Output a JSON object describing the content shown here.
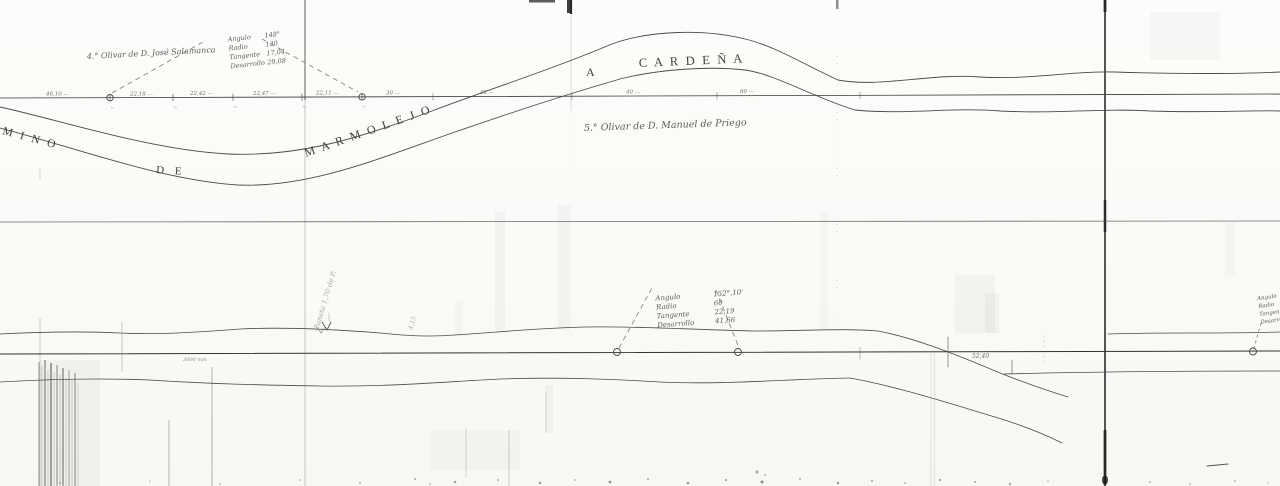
{
  "road_name": {
    "camino_left": "M I N O",
    "camino_de": "D E",
    "marmolejo": "M A R M O L E J O",
    "a": "A",
    "cardena": "C A R D E Ñ A"
  },
  "landmarks": {
    "olivar_4": "4.° Olivar de D. José Salamanca",
    "olivar_5": "5.° Olivar de D. Manuel de Priego"
  },
  "curve_table_top": {
    "rows": [
      {
        "label": "Angulo",
        "value": "148°"
      },
      {
        "label": "Radio",
        "value": "130"
      },
      {
        "label": "Tangente",
        "value": "17,04"
      },
      {
        "label": "Desarrollo",
        "value": "29,08"
      }
    ]
  },
  "curve_table_lower": {
    "rows": [
      {
        "label": "Angulo",
        "value": "152°,10'"
      },
      {
        "label": "Radio",
        "value": "60"
      },
      {
        "label": "Tangente",
        "value": "22,19"
      },
      {
        "label": "Desarrollo",
        "value": "41,66"
      }
    ]
  },
  "curve_table_right_clipped": {
    "rows": [
      "Angulo",
      "Radio",
      "Tangente",
      "Desarrollo"
    ]
  },
  "baseline_distances": [
    "46,10 —",
    "22,18 —",
    "22,42 —",
    "22,47 —",
    "22,11 —",
    "30 —",
    "42 —",
    "40 —",
    "60 —"
  ],
  "baseline_tick_numbers": [
    "2",
    "3",
    "2",
    "2",
    "3"
  ],
  "lower_baseline": {
    "left_note": "3000 mm",
    "distance_label": "52,40"
  },
  "pencil_notes": {
    "cuneta": "Cuneta 1,70 de P.",
    "grade": "4,15"
  },
  "colors": {
    "ink": "#3f3f3f",
    "paper": "#fbfbf8",
    "pencil": "#9a9a9a",
    "crease": "#222222"
  }
}
